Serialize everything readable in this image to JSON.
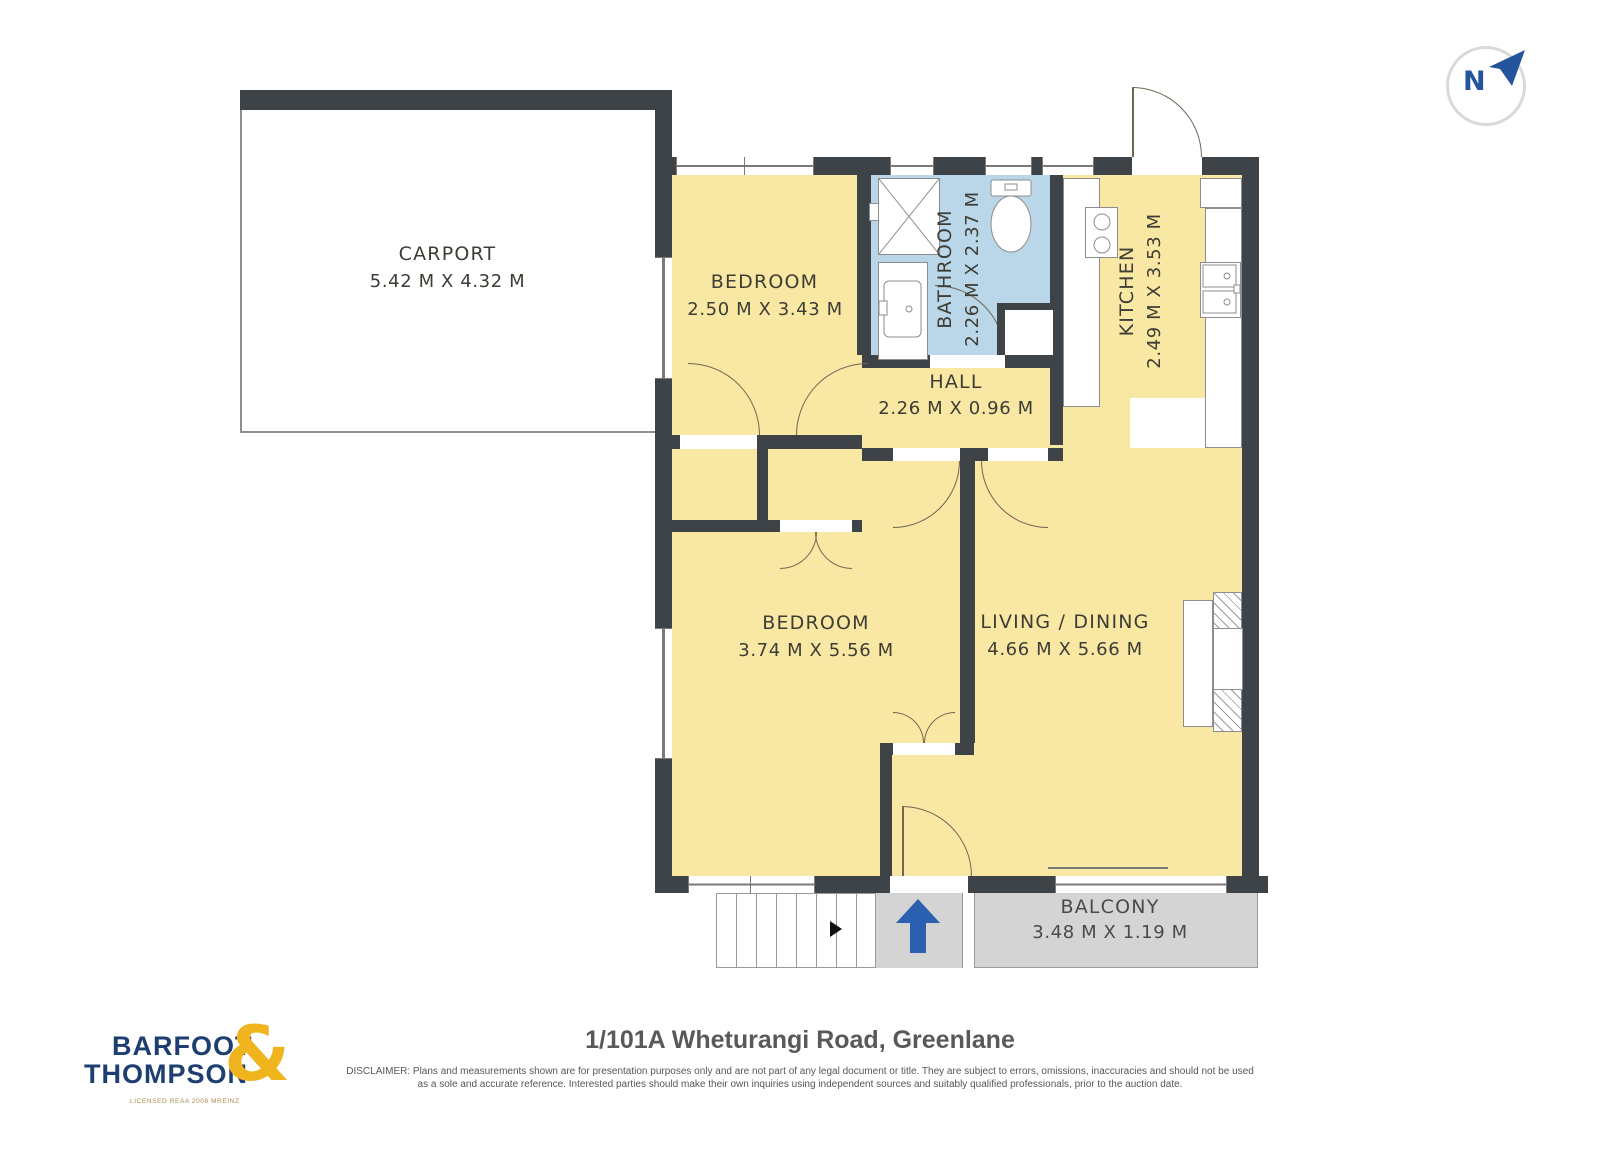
{
  "compass": {
    "letter": "N"
  },
  "plan": {
    "carport": {
      "name": "CARPORT",
      "dims": "5.42 M X 4.32 M"
    },
    "bedroom_top": {
      "name": "BEDROOM",
      "dims": "2.50 M X 3.43 M"
    },
    "bathroom": {
      "name": "BATHROOM",
      "dims": "2.26 M X 2.37 M"
    },
    "kitchen": {
      "name": "KITCHEN",
      "dims": "2.49 M X 3.53 M"
    },
    "hall": {
      "name": "HALL",
      "dims": "2.26 M X 0.96 M"
    },
    "bedroom_main": {
      "name": "BEDROOM",
      "dims": "3.74 M X 5.56 M"
    },
    "living": {
      "name": "LIVING / DINING",
      "dims": "4.66 M X 5.66 M"
    },
    "balcony": {
      "name": "BALCONY",
      "dims": "3.48 M X 1.19 M"
    }
  },
  "footer": {
    "address": "1/101A Wheturangi Road, Greenlane",
    "disclaimer_line1": "DISCLAIMER: Plans and measurements shown are for presentation purposes only and are not part of any legal document or title. They are subject to errors, omissions, inaccuracies and should not be used",
    "disclaimer_line2": "as a sole and accurate reference. Interested parties should make their own inquiries using independent sources and suitably qualified professionals, prior to the auction date."
  },
  "logo": {
    "line1": "BARFOOT",
    "line2": "THOMPSON",
    "ampersand": "&",
    "tagline": "LICENSED REAA 2008 MREINZ"
  },
  "colors": {
    "wall": "#3d4347",
    "room_fill": "#f9e7a4",
    "bathroom_fill": "#b9d7e8",
    "balcony_fill": "#d4d4d4",
    "logo_navy": "#1d3e70",
    "logo_gold": "#f0b41e",
    "entry_arrow_blue": "#2b5faf"
  }
}
